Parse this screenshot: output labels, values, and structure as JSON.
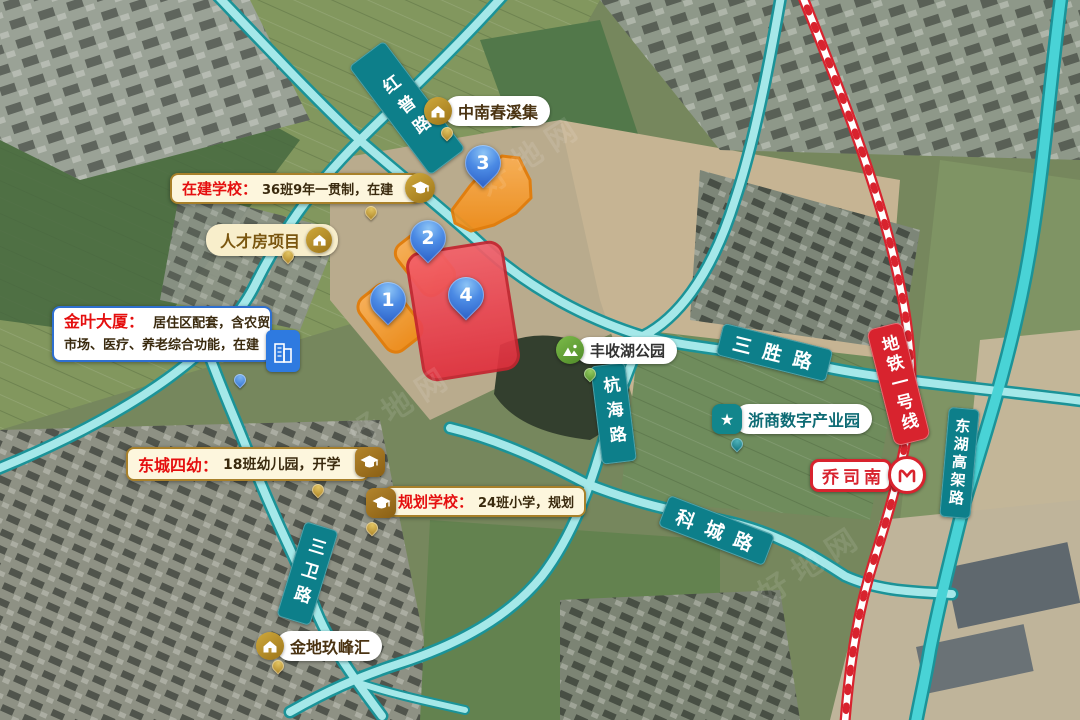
{
  "map": {
    "watermark": "好地网",
    "roads": {
      "hongpu": "红普路",
      "sansheng": "三胜路",
      "hanghai": "杭海路",
      "kecheng": "科城路",
      "sanwei": "三卫路",
      "donghu_viaduct": "东湖高架路"
    },
    "metro": {
      "line_label": "地铁一号线",
      "station_label": "乔司南"
    },
    "pins": [
      "1",
      "2",
      "3",
      "4"
    ],
    "pois": {
      "zhongnan_chunxiji": "中南春溪集",
      "talent_housing": "人才房项目",
      "fengshou_lake_park": "丰收湖公园",
      "zheshang_digital_park": "浙商数字产业园",
      "jindi_jiufenghui": "金地玖峰汇"
    },
    "callouts": {
      "school_in_construction": {
        "prefix": "在建学校：",
        "detail": "36班9年一贯制，在建"
      },
      "jinye_tower": {
        "prefix": "金叶大厦：",
        "line1": "居住区配套，含农贸",
        "line2": "市场、医疗、养老综合功能，在建"
      },
      "dongcheng_kindergarten": {
        "prefix": "东城四幼：",
        "detail": "18班幼儿园，开学"
      },
      "planned_school": {
        "prefix": "规划学校：",
        "detail": "24班小学，规划"
      }
    },
    "icons": {
      "star": "★"
    },
    "colors": {
      "road_casing": "#1b9398",
      "road_fill": "#a5e8e9",
      "ribbon_teal": "#0d7f8a",
      "metro_red": "#d8232e",
      "parcel_orange": "#f79b2e",
      "parcel_red": "#e8404a",
      "pin_blue": "#2b5fc6",
      "callout_gold": "#a8802a",
      "callout_blue": "#2e6fd0"
    }
  }
}
